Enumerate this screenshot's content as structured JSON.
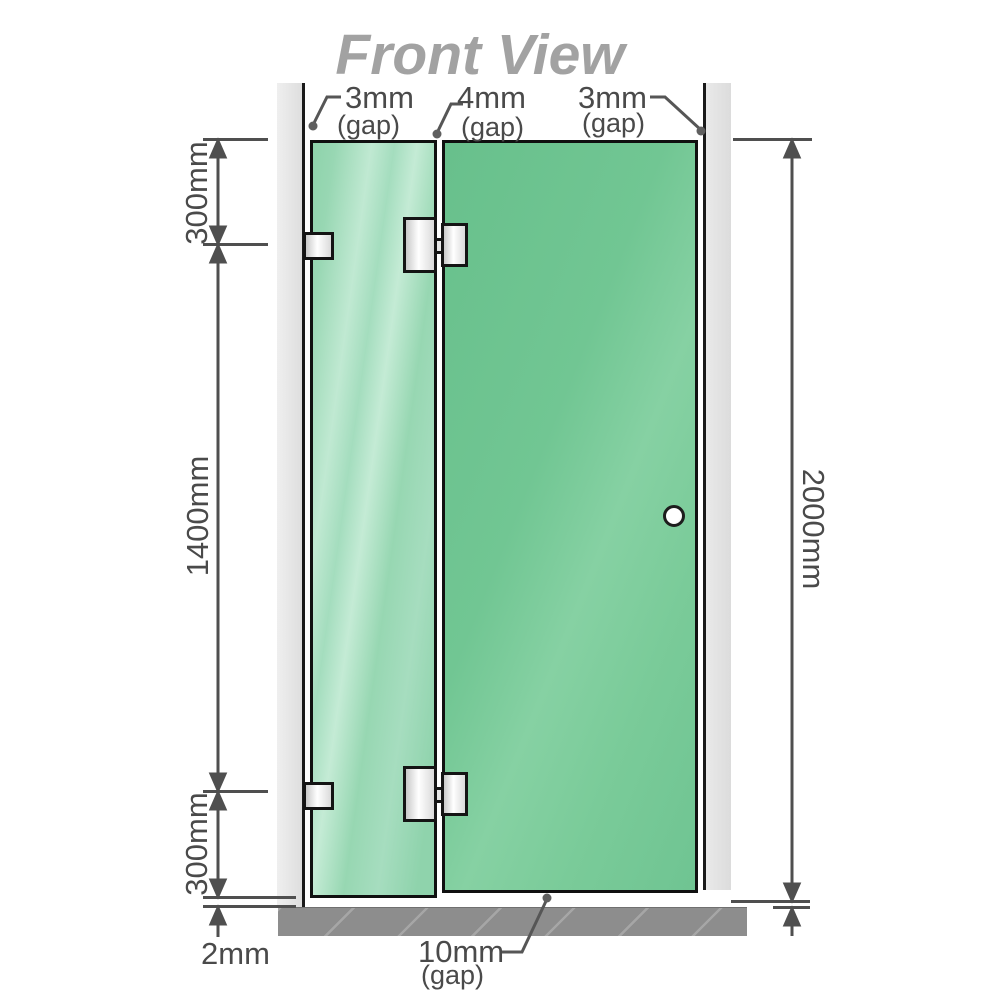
{
  "title": "Front View",
  "labels": {
    "gap_top_left_value": "3mm",
    "gap_top_left_unit": "(gap)",
    "gap_top_middle_value": "4mm",
    "gap_top_middle_unit": "(gap)",
    "gap_top_right_value": "3mm",
    "gap_top_right_unit": "(gap)",
    "gap_bottom_value": "10mm",
    "gap_bottom_unit": "(gap)",
    "dim_left_top": "300mm",
    "dim_left_middle": "1400mm",
    "dim_left_bottom": "300mm",
    "dim_bottom_left": "2mm",
    "dim_right": "2000mm"
  },
  "colors": {
    "title_gray": "#a2a2a2",
    "line_gray": "#4f4f4f",
    "glass_fixed_green": "#9ad7b5",
    "glass_door_green": "#72c795",
    "wall_gray": "#e4e4e4",
    "floor_gray": "#8d8d8d",
    "hardware_metal": "#e8e8e8"
  }
}
